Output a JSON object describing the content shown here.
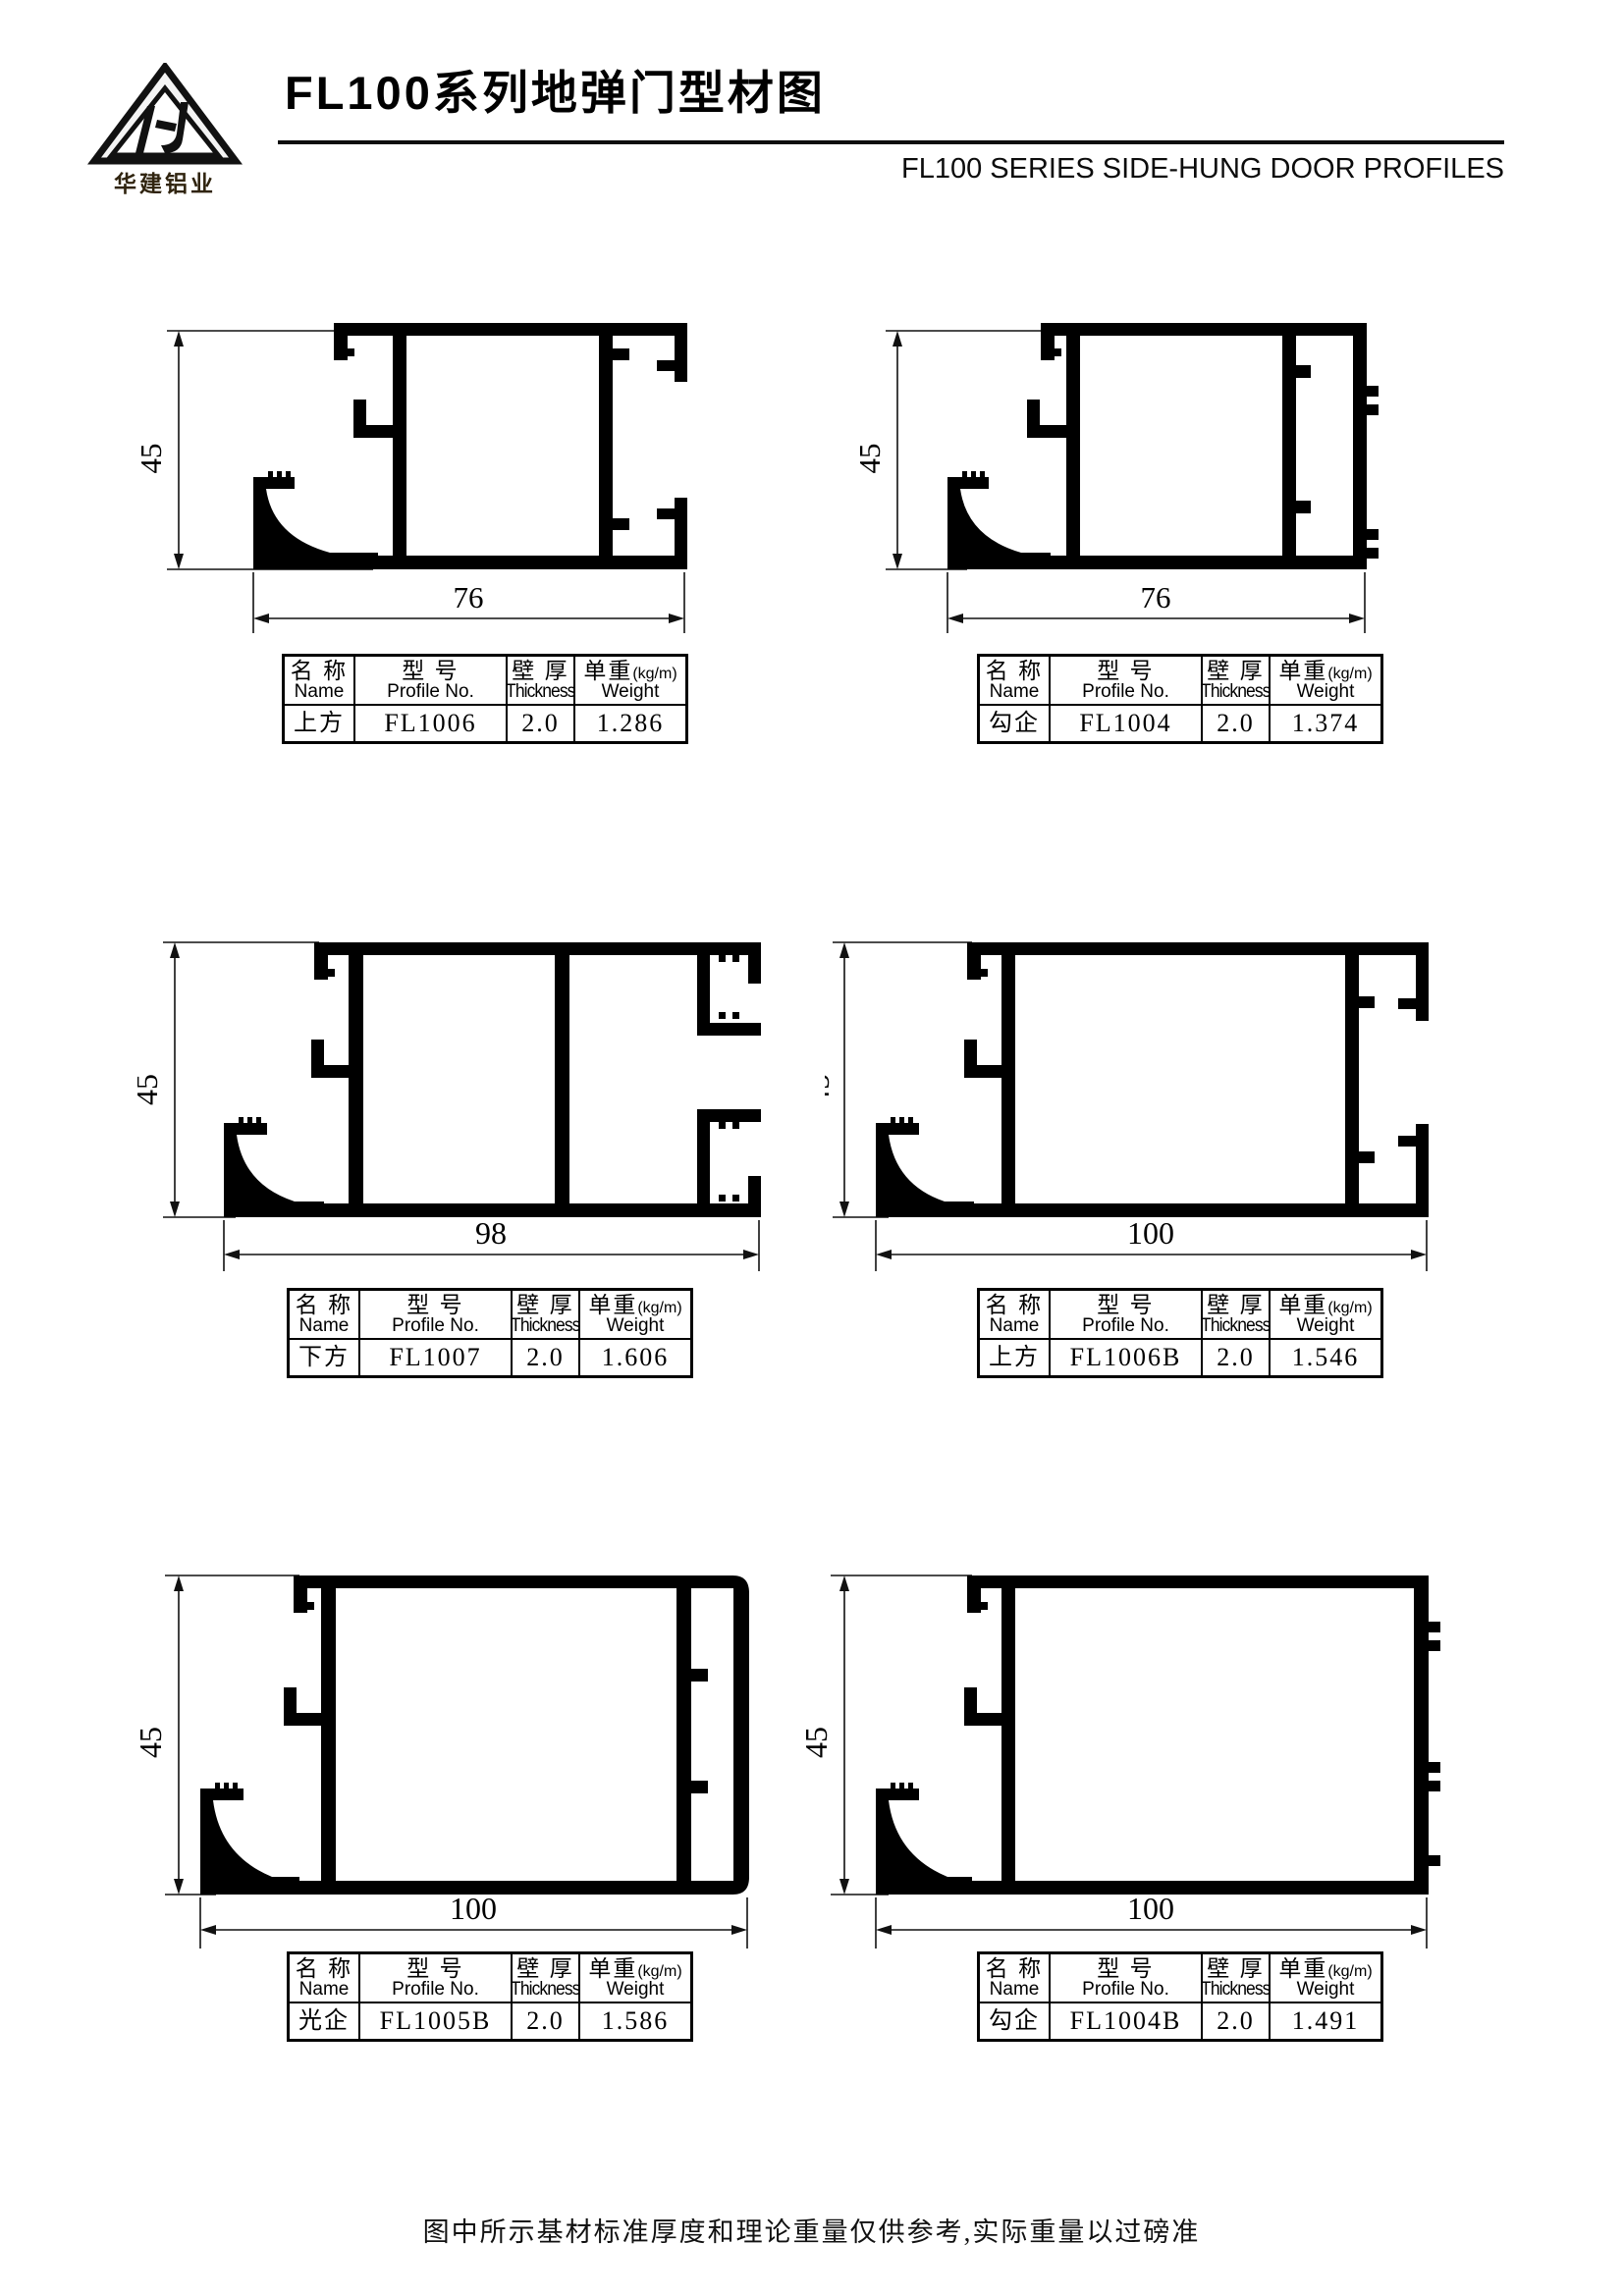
{
  "header": {
    "logo_monogram": "HJ",
    "company": "华建铝业",
    "title": "FL100系列地弹门型材图",
    "subtitle": "FL100 SERIES SIDE-HUNG DOOR PROFILES"
  },
  "table_headers": {
    "name_cn": "名 称",
    "name_en": "Name",
    "model_cn": "型 号",
    "model_en": "Profile No.",
    "thickness_cn": "壁 厚",
    "thickness_en": "Thickness",
    "weight_cn": "单重",
    "weight_unit": "(kg/m)",
    "weight_en": "Weight"
  },
  "figures": [
    {
      "height_label": "45",
      "width_label": "76",
      "row": {
        "name": "上方",
        "profile_no": "FL1006",
        "thickness": "2.0",
        "weight": "1.286"
      }
    },
    {
      "height_label": "45",
      "width_label": "76",
      "row": {
        "name": "勾企",
        "profile_no": "FL1004",
        "thickness": "2.0",
        "weight": "1.374"
      }
    },
    {
      "height_label": "45",
      "width_label": "98",
      "row": {
        "name": "下方",
        "profile_no": "FL1007",
        "thickness": "2.0",
        "weight": "1.606"
      }
    },
    {
      "height_label": "45",
      "width_label": "100",
      "row": {
        "name": "上方",
        "profile_no": "FL1006B",
        "thickness": "2.0",
        "weight": "1.546"
      }
    },
    {
      "height_label": "45",
      "width_label": "100",
      "row": {
        "name": "光企",
        "profile_no": "FL1005B",
        "thickness": "2.0",
        "weight": "1.586"
      }
    },
    {
      "height_label": "45",
      "width_label": "100",
      "row": {
        "name": "勾企",
        "profile_no": "FL1004B",
        "thickness": "2.0",
        "weight": "1.491"
      }
    }
  ],
  "footer": {
    "note": "图中所示基材标准厚度和理论重量仅供参考,实际重量以过磅准"
  },
  "colors": {
    "ink": "#000000",
    "paper": "#ffffff"
  }
}
